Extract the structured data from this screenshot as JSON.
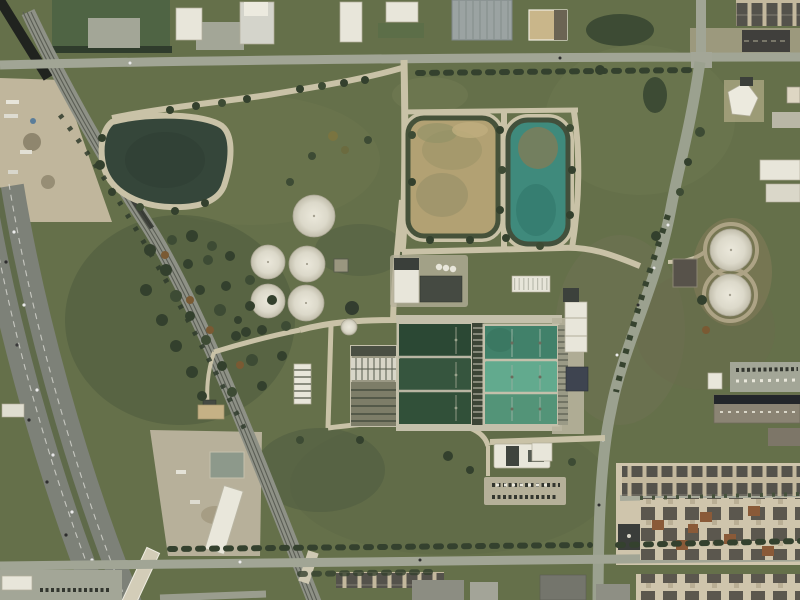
{
  "scene": {
    "type": "aerial-satellite-photograph",
    "subject": "overhead view of a municipal water treatment plant campus bounded by a diagonal highway and railroad on the west, arterial roads on the north, east and south, with a residential subdivision and commercial buildings to the southeast",
    "features": [
      {
        "id": "highway",
        "label": "multi-lane divided highway running diagonally through the lower-left"
      },
      {
        "id": "railroad",
        "label": "multi-track railroad corridor curving from upper-left to bottom-center-left"
      },
      {
        "id": "dark-pond",
        "label": "dark triangular storage pond with tan perimeter path, upper-left of plant"
      },
      {
        "id": "tan-pond",
        "label": "tan/turbid rounded-rectangular settling lagoon, top-center"
      },
      {
        "id": "teal-pond",
        "label": "teal rounded-rectangular lagoon east of the tan lagoon"
      },
      {
        "id": "digester-tanks-west",
        "label": "cluster of five white circular tanks (one large, four grouped) on west side of plant"
      },
      {
        "id": "storage-tanks-east",
        "label": "two large white circular storage tanks on brown ground, east of the plant"
      },
      {
        "id": "treatment-basins",
        "label": "large rectangular treatment basins: west block with dark green water, east block with lighter teal water, each split into three cells with central walkway gallery"
      },
      {
        "id": "aeration-channels",
        "label": "narrow parallel aeration/filter channels west of the basins"
      },
      {
        "id": "plant-buildings",
        "label": "white and dark flat-roofed process buildings north and east of the basins"
      },
      {
        "id": "admin-building",
        "label": "administration building with visitor parking lot full of cars, south of the basins"
      },
      {
        "id": "residential",
        "label": "dense single-family/townhome subdivision, bottom-right"
      },
      {
        "id": "commercial",
        "label": "industrial/commercial rooftops along the top edge and right edge"
      },
      {
        "id": "industrial-yard",
        "label": "dirt contractor yards with trucks and gravel piles on the far left"
      },
      {
        "id": "tree-cover",
        "label": "dense tree stands between the highway and railroad and along the roads"
      }
    ],
    "counts": {
      "white_circular_tanks": 7,
      "basin_blocks": 2,
      "cells_per_basin_block": 3,
      "lagoons": 3
    }
  },
  "palette": {
    "grass_base": "#65704a",
    "grass_dark": "#4f5b3e",
    "grass_light": "#6f7951",
    "highway_asphalt": "#7d8178",
    "highway_median": "#5f6a4a",
    "rail_bed": "#8e9186",
    "rail_shadow": "#20231f",
    "road_gray": "#a1a595",
    "road_tan": "#c9c2a7",
    "concrete": "#c4c0ab",
    "pond_dark": "#35463a",
    "pond_tan": "#b2a173",
    "pond_teal": "#3f8a7c",
    "basin_dark_green": "#2e4e3a",
    "basin_teal_top": "#41816a",
    "basin_teal_mid": "#62aa8e",
    "basin_teal_bottom": "#539478",
    "tank_white": "#dcd9ca",
    "building_white": "#e8e6da",
    "building_dark": "#454a42",
    "warehouse_gray": "#9ba3a2",
    "dirt_yard": "#c0b69c",
    "residential_ground": "#cfc5ac",
    "roof_dark": "#54524b",
    "roof_rust": "#8a5a38",
    "tree_dark": "#33402d"
  }
}
